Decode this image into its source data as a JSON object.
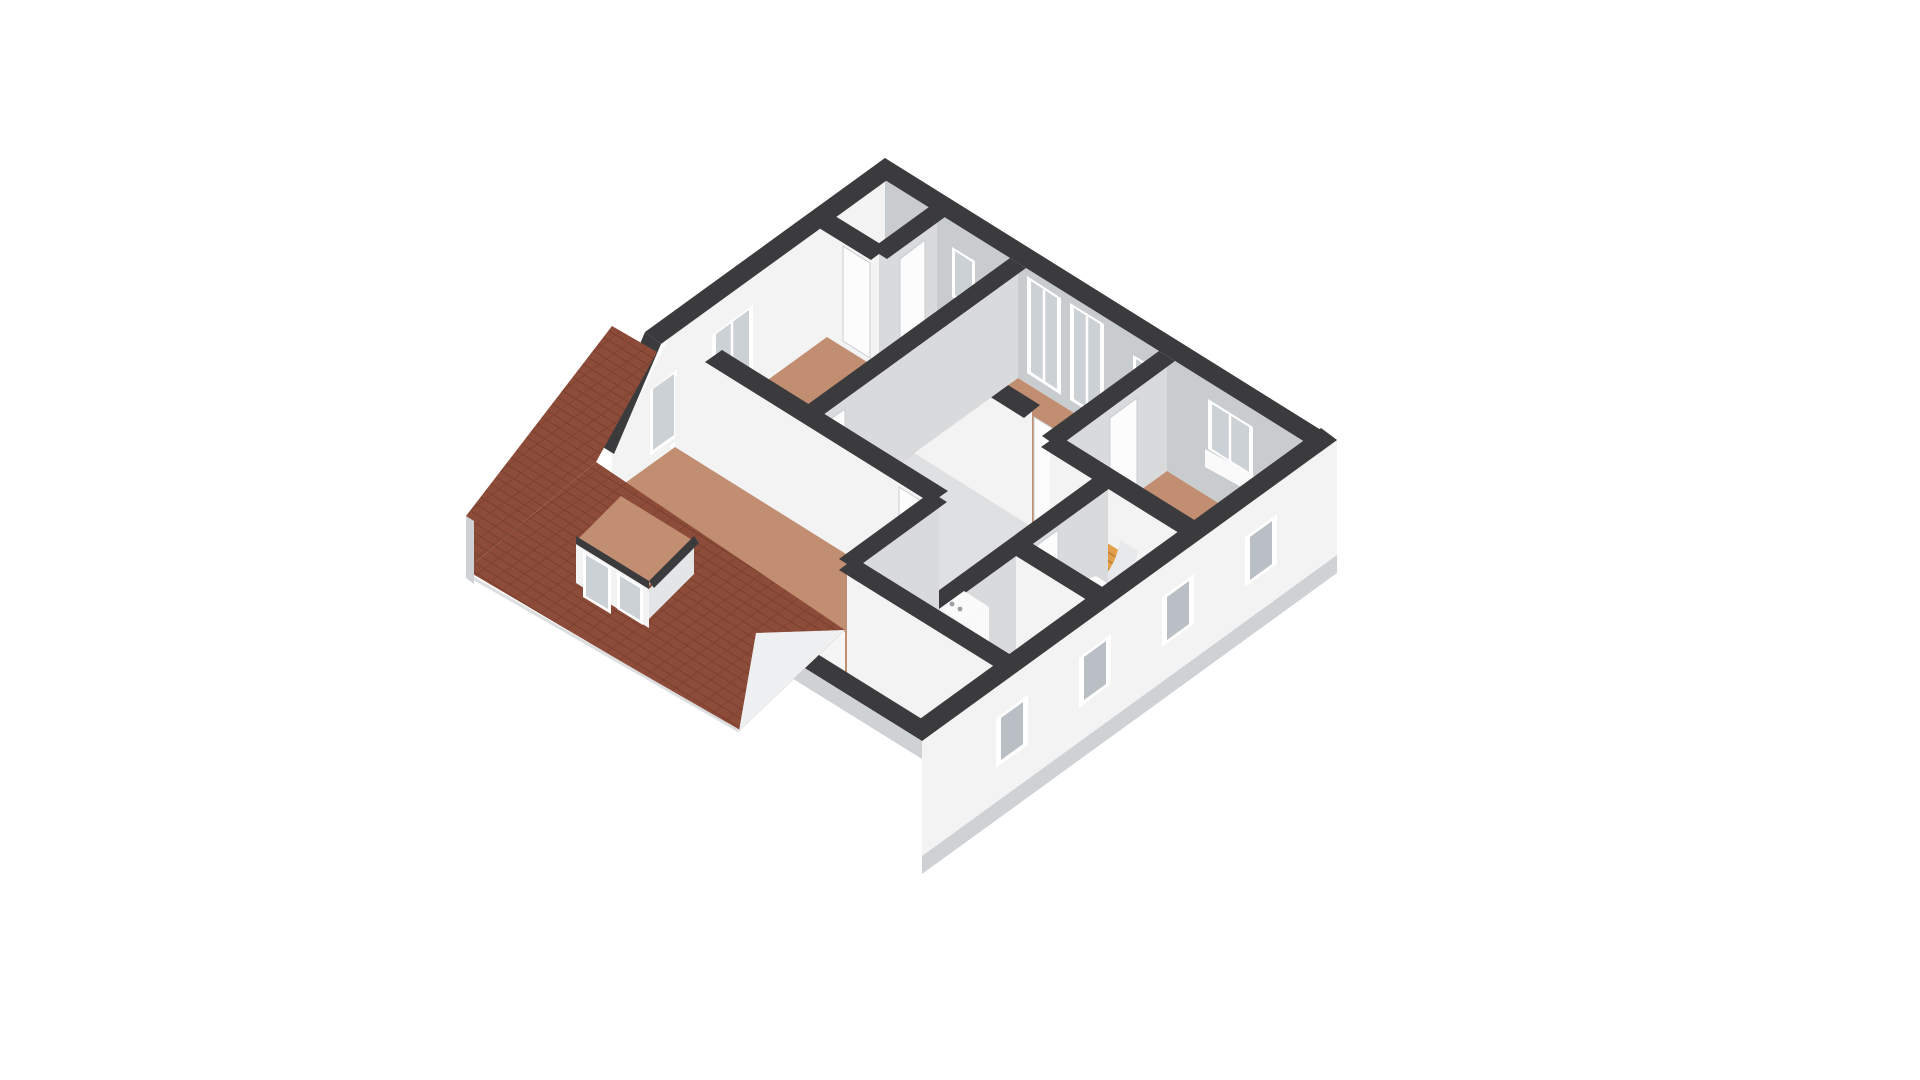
{
  "scene": {
    "type": "3d-floorplan-isometric-render",
    "background": "#ffffff",
    "features": [
      "hip-roof-with-clay-tiles",
      "dormer-with-two-windows",
      "skylight-window-in-gable-bevel",
      "staircase-with-wood-treads",
      "bathroom-with-toilet-and-washbasin",
      "boiler-unit",
      "radiator-sill-under-window",
      "interior-doors",
      "exterior-wall-window-openings"
    ]
  },
  "colors": {
    "background": "#ffffff",
    "wall_top": "#3b3b3d",
    "wall_white": "#f3f3f4",
    "wall_gray": "#d8dadc",
    "wall_inner_shade": "#c9ccce",
    "wall_knee": "#f5f5f6",
    "floor_wood": "#c18e71",
    "floor_hall": "#dfe0e2",
    "floor_closet": "#d4c0ae",
    "floor_bath": "#b3c8dc",
    "floor_utility": "#ded7c8",
    "stairs": "#e2a04b",
    "stairs_line": "#b97f35",
    "roof_tile": "#8d4c39",
    "roof_tile_line": "#6f3827",
    "roof_tile_line2": "#7c4030",
    "slab": "#cfd2d4",
    "slab_light": "#dcdee0",
    "glass": "#ccd1d5",
    "glass_dark": "#b9bfc4",
    "frame": "#ffffff",
    "fixture": "#fafafb",
    "fixture_shade": "#e8eaec",
    "gable_sliver": "#eef0f1",
    "curved_wall": "#e8e9ea",
    "dormer_side": "#e3e5e6",
    "boiler_dot": "#9aa0a5",
    "door": "#fcfcfd",
    "door_edge": "#c9cdd0"
  }
}
